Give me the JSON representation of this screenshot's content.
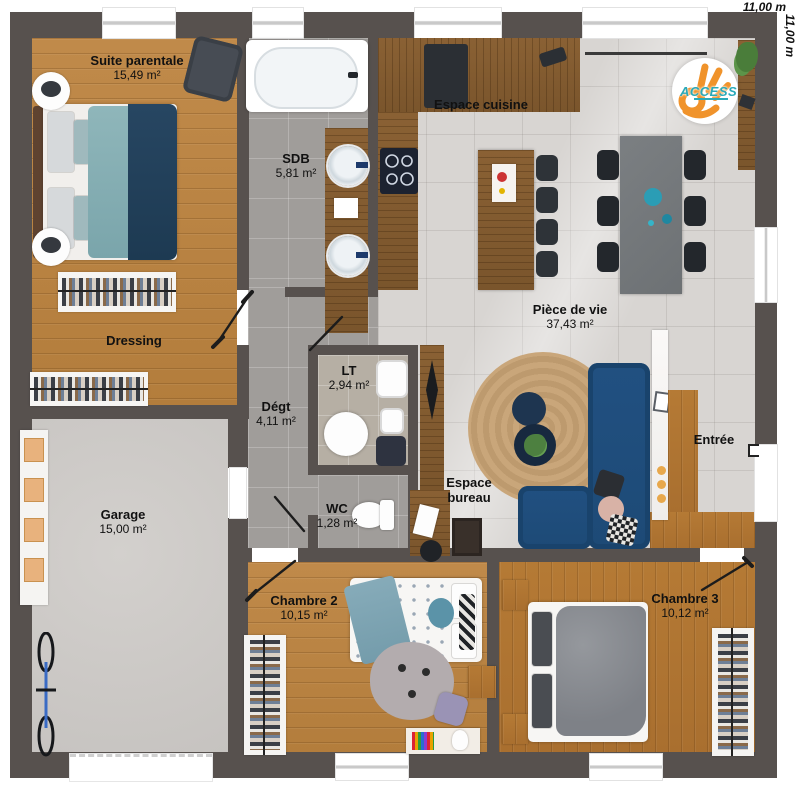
{
  "dimensions": {
    "top": "11,00 m",
    "right": "11,00 m"
  },
  "logo": {
    "brand": "ACCESS"
  },
  "rooms": {
    "suite_parentale": {
      "name": "Suite parentale",
      "area": "15,49 m²"
    },
    "sdb": {
      "name": "SDB",
      "area": "5,81 m²"
    },
    "espace_cuisine": {
      "name": "Espace cuisine"
    },
    "piece_de_vie": {
      "name": "Pièce de vie",
      "area": "37,43 m²"
    },
    "dressing": {
      "name": "Dressing"
    },
    "degt": {
      "name": "Dégt",
      "area": "4,11 m²"
    },
    "lt": {
      "name": "LT",
      "area": "2,94 m²"
    },
    "wc": {
      "name": "WC",
      "area": "1,28 m²"
    },
    "espace_bureau": {
      "name": "Espace bureau"
    },
    "entree": {
      "name": "Entrée"
    },
    "garage": {
      "name": "Garage",
      "area": "15,00 m²"
    },
    "chambre_2": {
      "name": "Chambre 2",
      "area": "10,15 m²"
    },
    "chambre_3": {
      "name": "Chambre 3",
      "area": "10,12 m²"
    }
  },
  "colors": {
    "wall": "#57514e",
    "wood": "#b57a35",
    "sofa_blue": "#1d4a76",
    "logo_orange": "#f0932b",
    "logo_teal": "#2aa9b8"
  }
}
